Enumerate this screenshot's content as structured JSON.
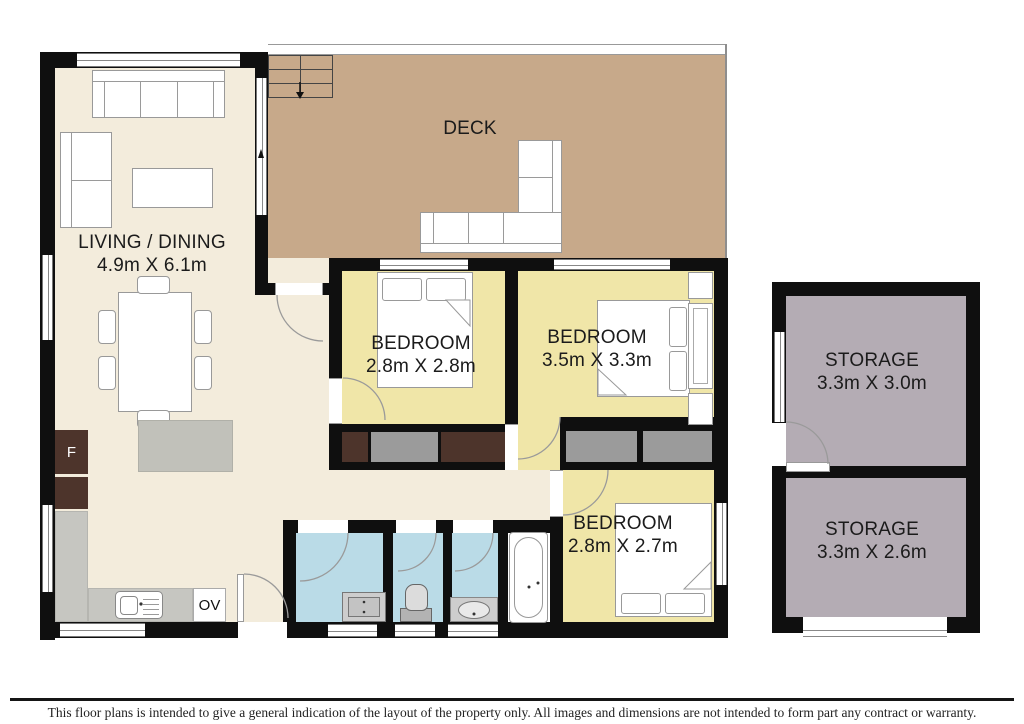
{
  "rooms": {
    "living": {
      "label": "LIVING / DINING",
      "dims": "4.9m X 6.1m"
    },
    "deck": {
      "label": "DECK"
    },
    "bedroom1": {
      "label": "BEDROOM",
      "dims": "2.8m X 2.8m"
    },
    "bedroom2": {
      "label": "BEDROOM",
      "dims": "3.5m X 3.3m"
    },
    "bedroom3": {
      "label": "BEDROOM",
      "dims": "2.8m X 2.7m"
    },
    "storage1": {
      "label": "STORAGE",
      "dims": "3.3m X 3.0m"
    },
    "storage2": {
      "label": "STORAGE",
      "dims": "3.3m X 2.6m"
    }
  },
  "appliances": {
    "fridge": "F",
    "oven": "OV"
  },
  "footer": {
    "disclaimer": "This floor plans is intended to give a general indication of the layout of the property only. All images and dimensions are not intended to form part any contract or warranty."
  },
  "colors": {
    "wall": "#0f0f0f",
    "living": "#f3ecdc",
    "deck": "#c7a98a",
    "bedroom": "#f0e6a8",
    "bath": "#badbe7",
    "storage": "#b4acb4",
    "wardrobe_dark": "#4d342b",
    "wardrobe_gray": "#9b9b9b",
    "counter": "#c6c6c1"
  }
}
